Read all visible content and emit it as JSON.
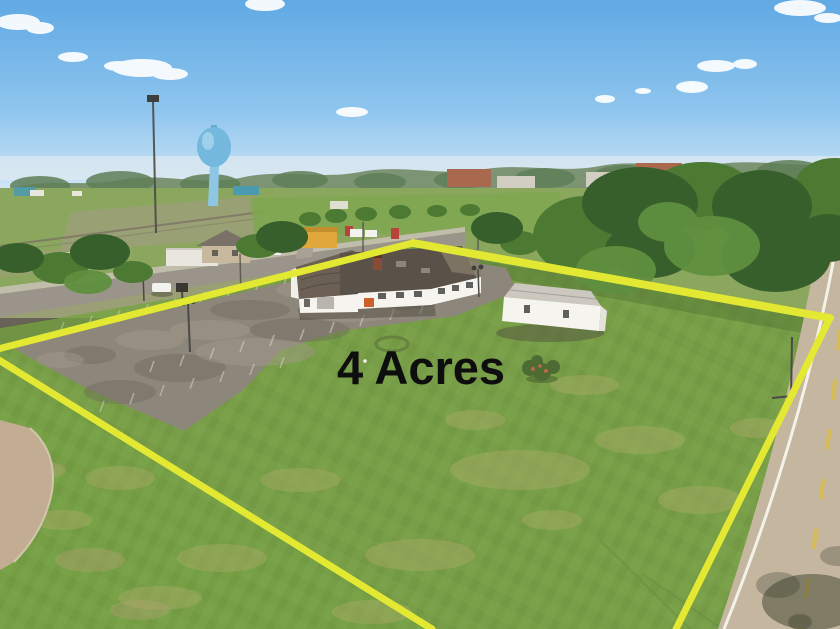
{
  "scene": {
    "type": "aerial-drone-real-estate-photo",
    "subject": "4 acre property with buildings, parking lot and lawn outlined in yellow"
  },
  "labels": {
    "area": "4 Acres"
  },
  "colors": {
    "sky_top": "#60a9e4",
    "sky_mid": "#8ec5ee",
    "sky_horizon": "#d8eaf7",
    "cloud": "#ffffff",
    "haze": "#dfeaf0",
    "far_trees": "#7c9474",
    "far_trees_dark": "#5f7e57",
    "town_field": "#8aa75d",
    "bright_field": "#7fa751",
    "dirt": "#a59a85",
    "dirt2": "#998a6f",
    "rail": "#7a7265",
    "street": "#9a948a",
    "sidewalk": "#c6c0b4",
    "cross_street": "#a8a296",
    "tree_dark": "#375f2b",
    "tree_mid": "#4c7a33",
    "tree_light": "#5f8f3e",
    "lawn": "#7ba24a",
    "lawn_outside": "#79a348",
    "lawn_patch": "#a9ab66",
    "brown_patch": "#b2a272",
    "mow_shade": "#2f4a1a",
    "asphalt": "#8d867a",
    "asphalt_dark": "#6e675c",
    "asphalt_light": "#a49b8b",
    "stripe": "#d6d0c2",
    "boundary": "#e3e832",
    "road_surface": "#c5b69f",
    "road_line": "#f4f1e8",
    "road_dash": "#d9bc4e",
    "road_shadow": "#39402c",
    "pavement": "#c3ad92",
    "curb": "#dbcfb9",
    "wall": "#f6f4ef",
    "roof_dark": "#5a5248",
    "roof_worn": "#8a7f6b",
    "barrel_roof": "#6b6053",
    "roof_streak": "#4a443c",
    "roof_edge": "#d9d5cc",
    "roof_unit": "#8d867c",
    "chimney": "#8a4a38",
    "chimney_top": "#5e3326",
    "orange": "#cc5f2a",
    "garage_door": "#b9b5ac",
    "out_roof": "#ccc8c0",
    "out_gable": "#e5e2da",
    "window": "#3a3a38",
    "bld_shadow": "#50493f",
    "grass_shadow": "#3c5c28",
    "water_tower": "#74b8dd",
    "water_col": "#8ec7e4",
    "water_hl": "#a8d6ee",
    "water_top": "#6aa8cc",
    "pole": "#4a4a46",
    "pole_head": "#3f3f3c",
    "car_white": "#f2f2ee",
    "car_dark": "#3f4448",
    "car_red": "#b8433a",
    "sign": "#3a3632",
    "house_tan": "#c8b89e",
    "house_roof": "#7a7268",
    "bld_white": "#e8e6df",
    "bld_white_roof": "#cfcabf",
    "bld_yellow": "#e0a73c",
    "bld_yellow_roof": "#c28f2e",
    "brick": "#a8694f",
    "bld_gray": "#d2cec4",
    "teal": "#4a9ab0",
    "garden_ring": "#647e3e",
    "bush": "#4e6b33",
    "bush_flower": "#b86a4a",
    "track": "#6b8f42",
    "shadow_soft": "#2c3c22",
    "white_dot": "#f5f5f0",
    "text": "#0e0e0e"
  }
}
